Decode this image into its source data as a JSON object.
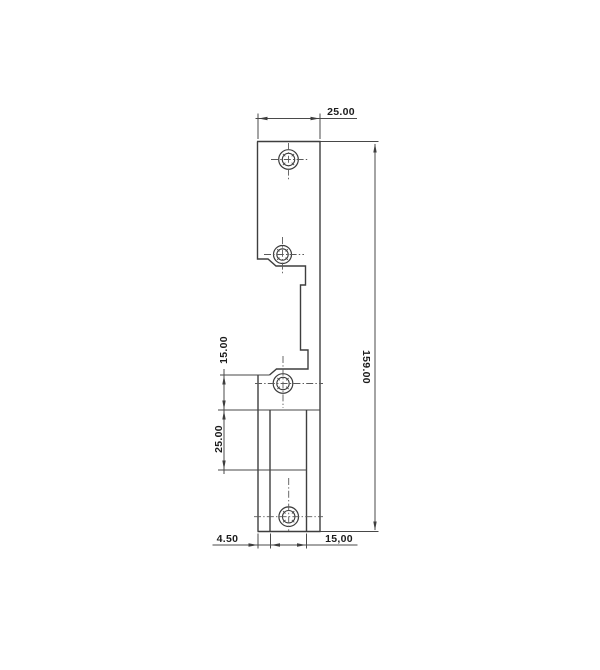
{
  "page": {
    "background": "#ffffff",
    "line_color": "#3e3e3e"
  },
  "drawing": {
    "kind": "technical-drawing",
    "view": "strike-plate-profile",
    "dimensions": [
      {
        "id": "top-width",
        "label": "25.00"
      },
      {
        "id": "overall-height",
        "label": "159.00"
      },
      {
        "id": "latch-offset",
        "label": "15.00"
      },
      {
        "id": "keeper-height",
        "label": "25.00"
      },
      {
        "id": "bottom-left-offset",
        "label": "4.50"
      },
      {
        "id": "bottom-width",
        "label": "15,00"
      }
    ]
  }
}
